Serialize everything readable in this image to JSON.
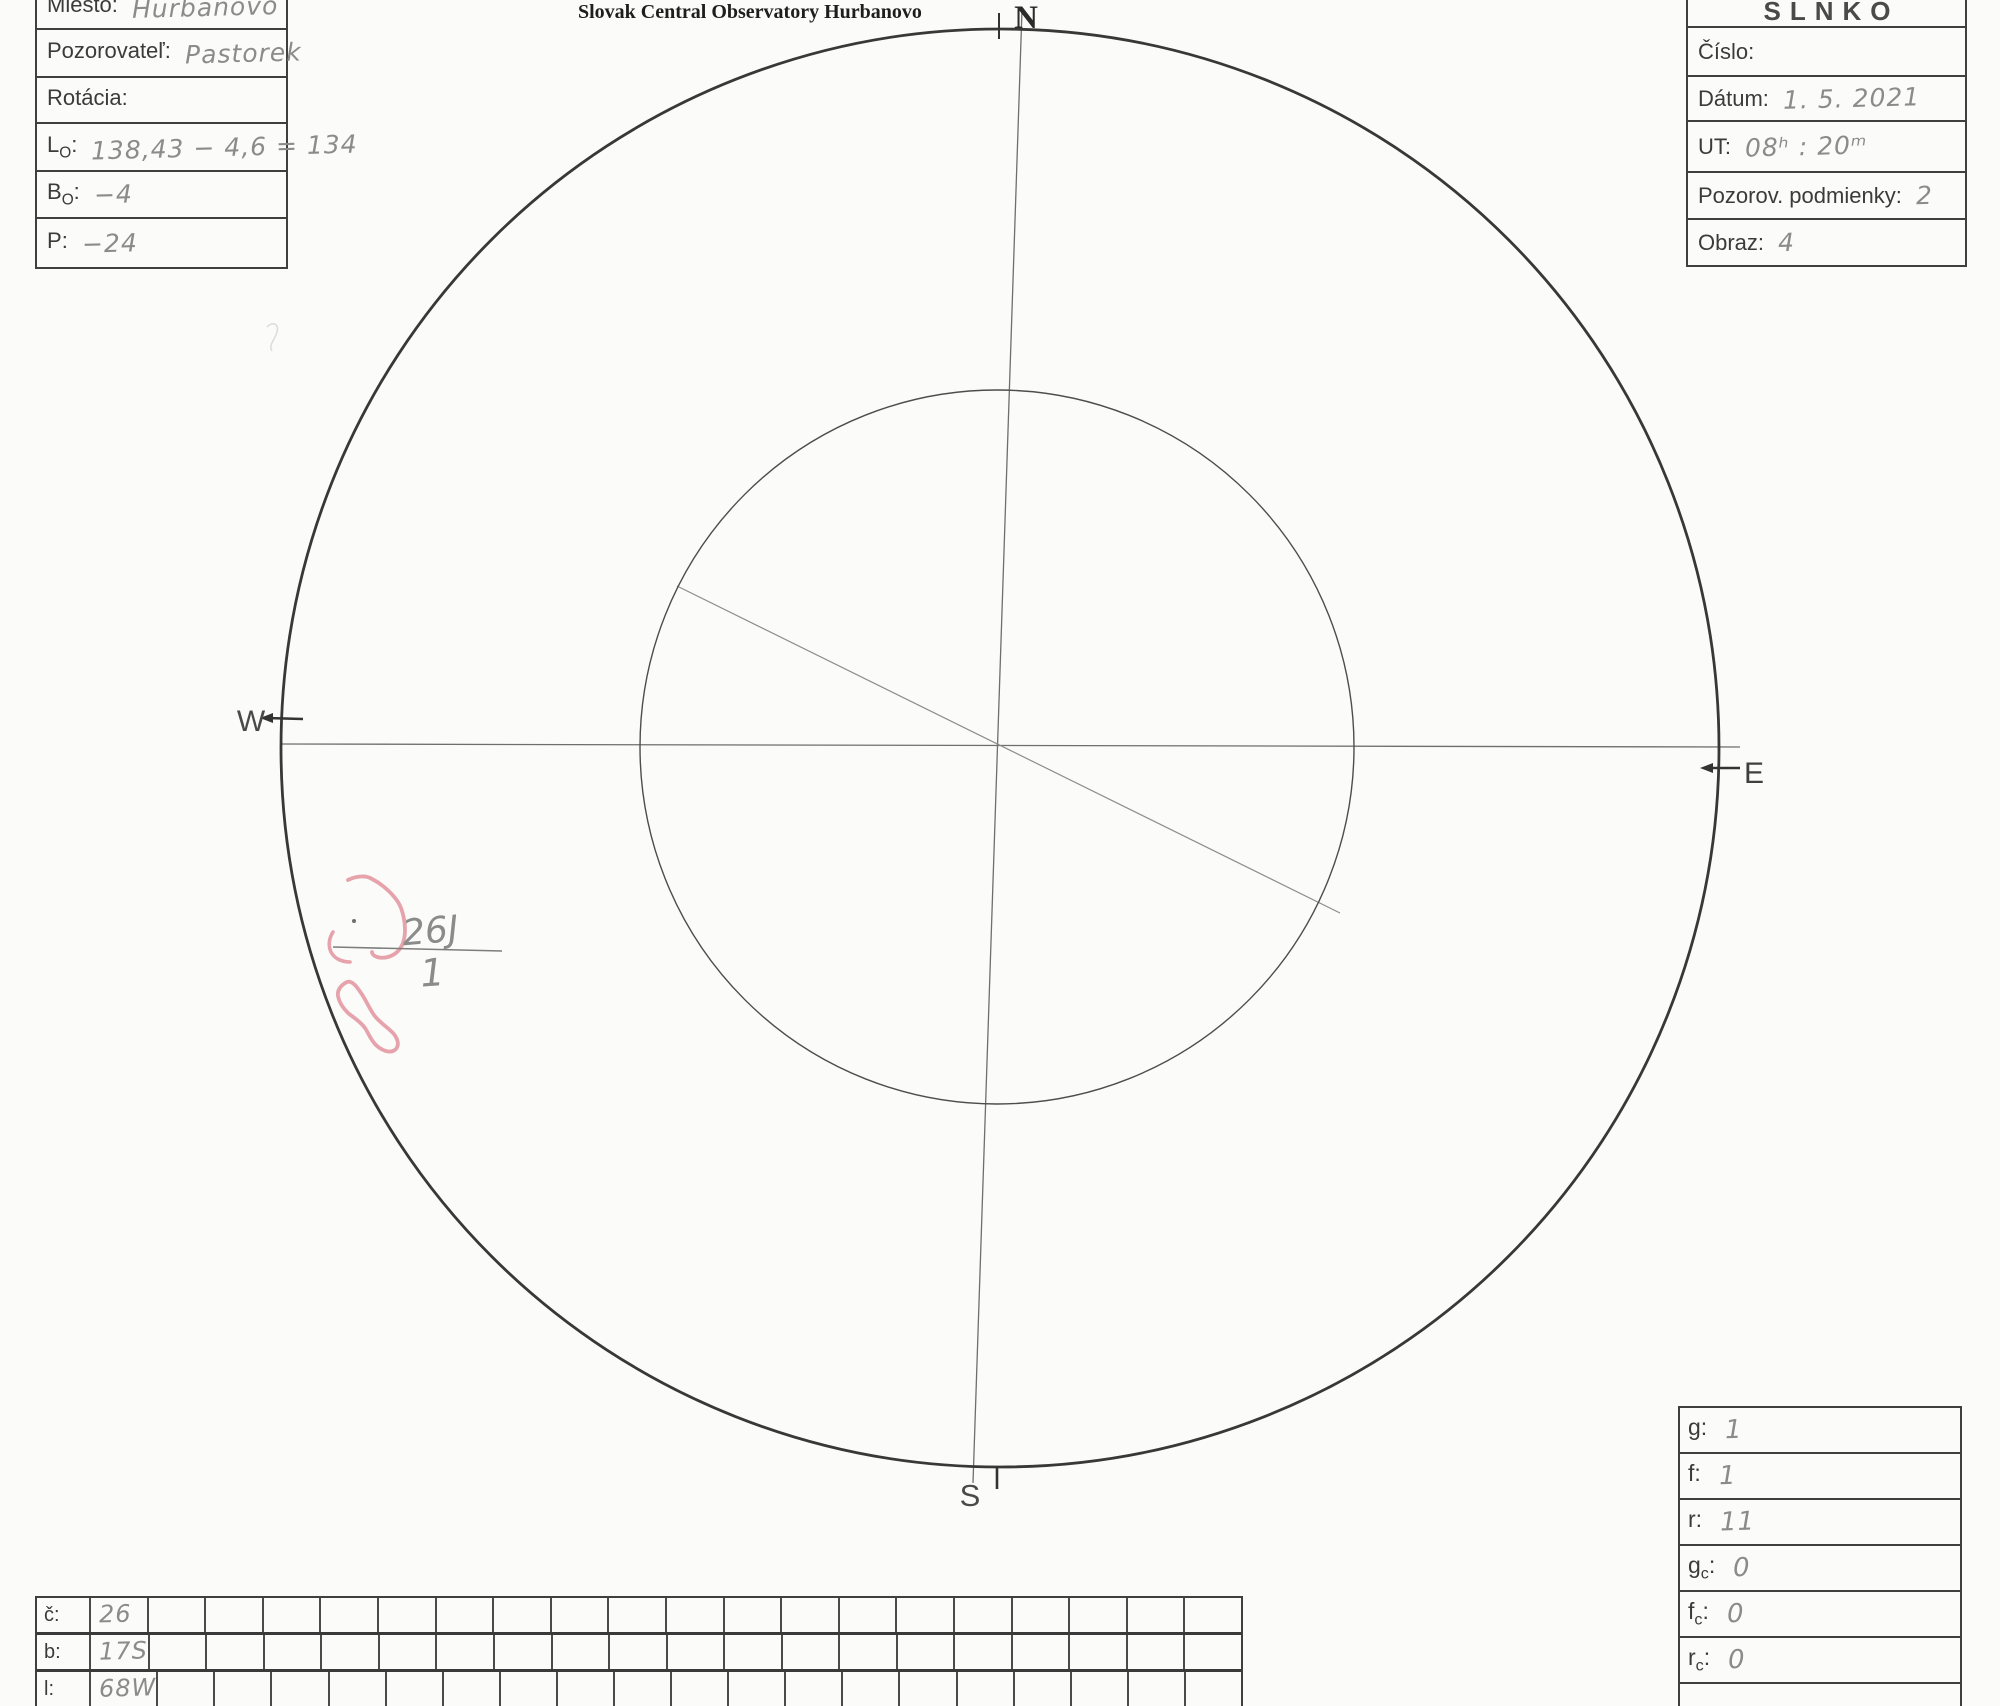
{
  "title": "Slovak Central Observatory Hurbanovo",
  "colors": {
    "paper": "#fbfbf9",
    "ink": "#3b3b3b",
    "pencil": "#8b8b8b",
    "red_marker": "#e2939f"
  },
  "compass": {
    "north": "N",
    "south": "S",
    "east": "E",
    "west": "W"
  },
  "left_form": {
    "rows": [
      {
        "label": "Miesto",
        "sub": "",
        "suffix": ":",
        "value": "Hurbanovo"
      },
      {
        "label": "Pozorovateľ",
        "sub": "",
        "suffix": ":",
        "value": "Pastorek"
      },
      {
        "label": "Rotácia",
        "sub": "",
        "suffix": ":",
        "value": ""
      },
      {
        "label": "L",
        "sub": "O",
        "suffix": ":",
        "value": "138,43 − 4,6 = 134"
      },
      {
        "label": "B",
        "sub": "O",
        "suffix": ":",
        "value": "−4"
      },
      {
        "label": "P",
        "sub": "",
        "suffix": ":",
        "value": "−24"
      }
    ]
  },
  "right_form": {
    "header": "SLNKO",
    "rows": [
      {
        "label": "Číslo",
        "suffix": ":",
        "value": ""
      },
      {
        "label": "Dátum",
        "suffix": ":",
        "value": "1. 5. 2021"
      },
      {
        "label": "UT",
        "suffix": ":",
        "value": "08ʰ : 20ᵐ"
      },
      {
        "label": "Pozorov. podmienky",
        "suffix": ":",
        "value": "2"
      },
      {
        "label": "Obraz",
        "suffix": ":",
        "value": "4"
      }
    ]
  },
  "sunspot_annotation": {
    "group_label": "26J",
    "group_count": "1"
  },
  "summary_table": {
    "rows": [
      {
        "label": "g",
        "sub": "",
        "suffix": ":",
        "value": "1"
      },
      {
        "label": "f",
        "sub": "",
        "suffix": ":",
        "value": "1"
      },
      {
        "label": "r",
        "sub": "",
        "suffix": ":",
        "value": "11"
      },
      {
        "label": "g",
        "sub": "c",
        "suffix": ":",
        "value": "0"
      },
      {
        "label": "f",
        "sub": "c",
        "suffix": ":",
        "value": "0"
      },
      {
        "label": "r",
        "sub": "c",
        "suffix": ":",
        "value": "0"
      }
    ]
  },
  "positions_table": {
    "extra_columns": 19,
    "rows": [
      {
        "label": "č",
        "suffix": ":",
        "value": "26"
      },
      {
        "label": "b",
        "suffix": ":",
        "value": "17S"
      },
      {
        "label": "l",
        "suffix": ":",
        "value": "68W"
      }
    ]
  }
}
